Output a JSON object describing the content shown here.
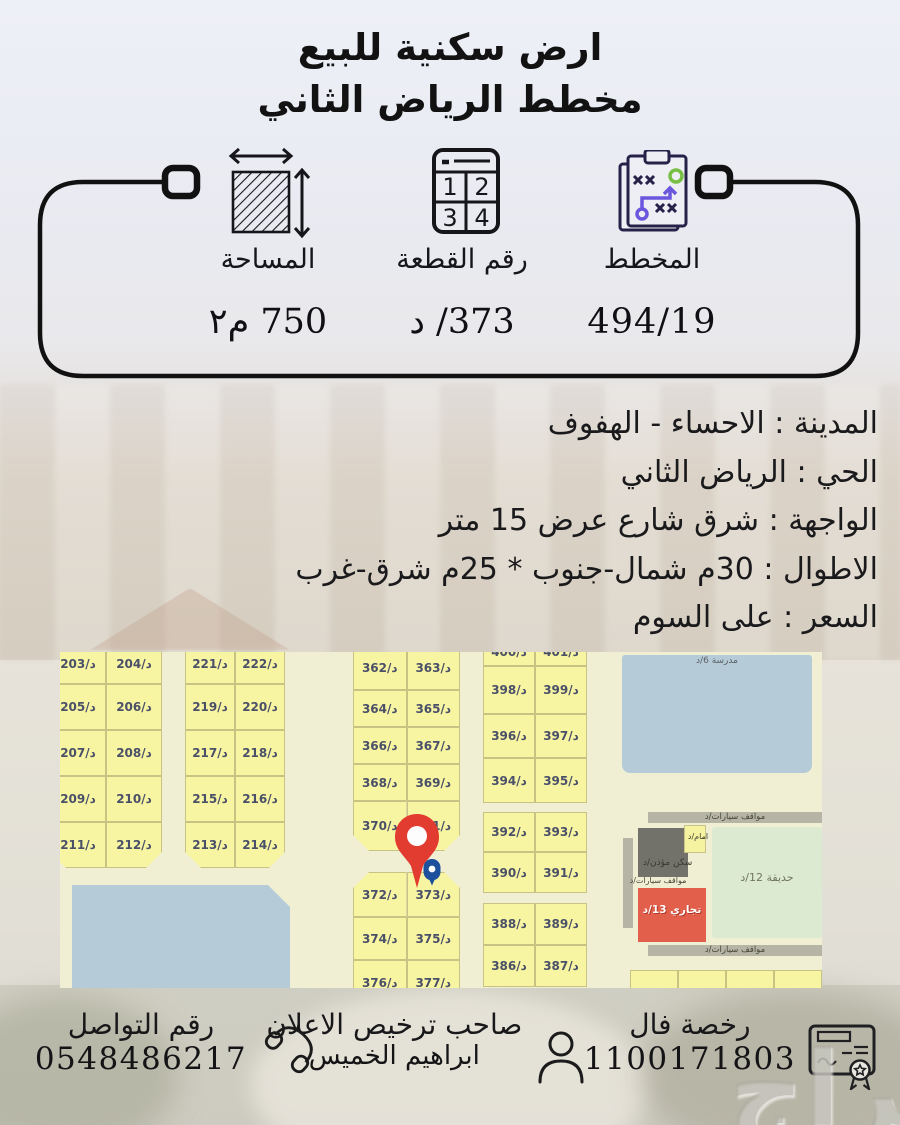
{
  "page": {
    "title_line1": "ارض سكنية للبيع",
    "title_line2": "مخطط الرياض الثاني"
  },
  "summary_card": {
    "items": [
      {
        "id": "plan",
        "label": "المخطط",
        "value": "494/19"
      },
      {
        "id": "plot_number",
        "label": "رقم القطعة",
        "value": "373/ د",
        "icon_digits": [
          "1",
          "2",
          "3",
          "4"
        ]
      },
      {
        "id": "area",
        "label": "المساحة",
        "value": "750 م٢"
      }
    ]
  },
  "details": {
    "lines": [
      "المدينة : الاحساء - الهفوف",
      "الحي : الرياض الثاني",
      "الواجهة : شرق شارع عرض 15 متر",
      "الاطوال : 30م شمال-جنوب * 25م شرق-غرب",
      "السعر : على السوم"
    ]
  },
  "map": {
    "blocks": {
      "a": {
        "rows": [
          [
            "203/د",
            "204/د"
          ],
          [
            "205/د",
            "206/د"
          ],
          [
            "207/د",
            "208/د"
          ],
          [
            "209/د",
            "210/د"
          ],
          [
            "211/د",
            "212/د"
          ]
        ]
      },
      "b": {
        "rows": [
          [
            "221/د",
            "222/د"
          ],
          [
            "219/د",
            "220/د"
          ],
          [
            "217/د",
            "218/د"
          ],
          [
            "215/د",
            "216/د"
          ],
          [
            "213/د",
            "214/د"
          ]
        ]
      },
      "c1": {
        "rows": [
          [
            "362/د",
            "363/د"
          ],
          [
            "364/د",
            "365/د"
          ],
          [
            "366/د",
            "367/د"
          ],
          [
            "368/د",
            "369/د"
          ],
          [
            "370/د",
            "371/د"
          ]
        ]
      },
      "c2": {
        "rows": [
          [
            "372/د",
            "373/د"
          ],
          [
            "374/د",
            "375/د"
          ],
          [
            "376/د",
            "377/د"
          ]
        ]
      },
      "d1": {
        "rows": [
          [
            "400/د",
            "401/د"
          ],
          [
            "398/د",
            "399/د"
          ],
          [
            "396/د",
            "397/د"
          ],
          [
            "394/د",
            "395/د"
          ]
        ]
      },
      "d2": {
        "rows": [
          [
            "392/د",
            "393/د"
          ],
          [
            "390/د",
            "391/د"
          ]
        ]
      },
      "d3": {
        "rows": [
          [
            "388/د",
            "389/د"
          ],
          [
            "386/د",
            "387/د"
          ]
        ]
      }
    },
    "facilities": {
      "school": "مدرسة 6/د",
      "parking_top": "مواقف سيارات/د",
      "parking_side": "مواقف سيارات/د",
      "parking_bottom": "مواقف سيارات/د",
      "imam": "امام/د",
      "muezzin": "سكن مؤذن/د",
      "garden": "حديقة 12/د",
      "commercial": "تجاري 13/د"
    },
    "highlighted_plot": "373/د"
  },
  "footer": {
    "license": {
      "label": "رخصة فال",
      "value": "1100171803"
    },
    "advertiser": {
      "label": "صاحب ترخيص الاعلان",
      "value": "ابراهيم الخميس"
    },
    "contact": {
      "label": "رقم التواصل",
      "value": "0548486217"
    }
  },
  "watermark": "حراج"
}
